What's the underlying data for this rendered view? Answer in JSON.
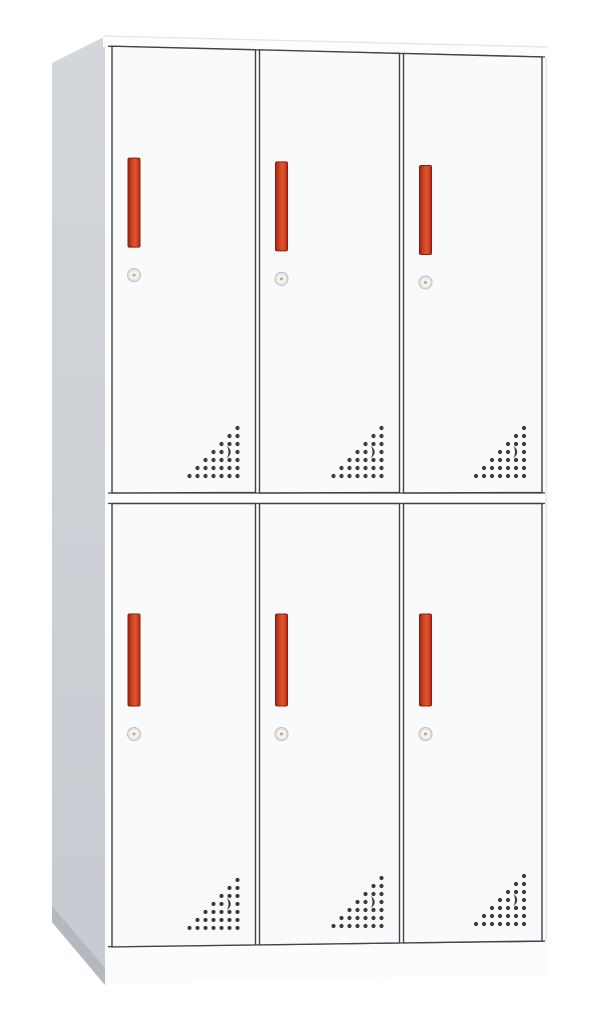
{
  "image": {
    "type": "product-photo",
    "subject": "six-door steel locker wardrobe cabinet, white body with red-orange handles",
    "background": "#ffffff"
  },
  "locker": {
    "rows": 2,
    "columns": 3,
    "door_count": 6,
    "row_names": [
      "top",
      "bottom"
    ],
    "column_names": [
      "left",
      "middle",
      "right"
    ],
    "handle_style": "vertical recessed bar",
    "handle_color_name": "red-orange",
    "lock_style": "round cam lock with keyhole",
    "vent_pattern": {
      "shape": "right-triangle dot grid, anchored to door bottom-right corner",
      "rows": 7,
      "max_dots_per_row": 7,
      "dot_spacing_px": 8,
      "accent": "crescent-cutout at row 4, column 6"
    },
    "colors": {
      "background": "#ffffff",
      "side_panel_top": "#d3d7db",
      "side_panel": "#c6cbd1",
      "side_panel_shadow": "#b3b9bf",
      "top_surface": "#fdfdfe",
      "top_edge_line": "#e2e5e8",
      "front_face": "#fdfdfe",
      "plinth": "#fbfcfd",
      "right_edge_line": "#e3e6e9",
      "door_face": "#f9fafb",
      "door_border": "#3f4449",
      "handle_dark": "#9c2310",
      "handle_mid": "#d14524",
      "handle_main": "#e65530",
      "handle_edge": "#b02c13",
      "handle_border": "#8a1e0c",
      "lock_face_center": "#fbf9f6",
      "lock_face_edge": "#e2e0dc",
      "lock_ring": "#bcbfc3",
      "lock_pin": "#cfa878",
      "vent_dot": "#3a3b3d"
    }
  }
}
